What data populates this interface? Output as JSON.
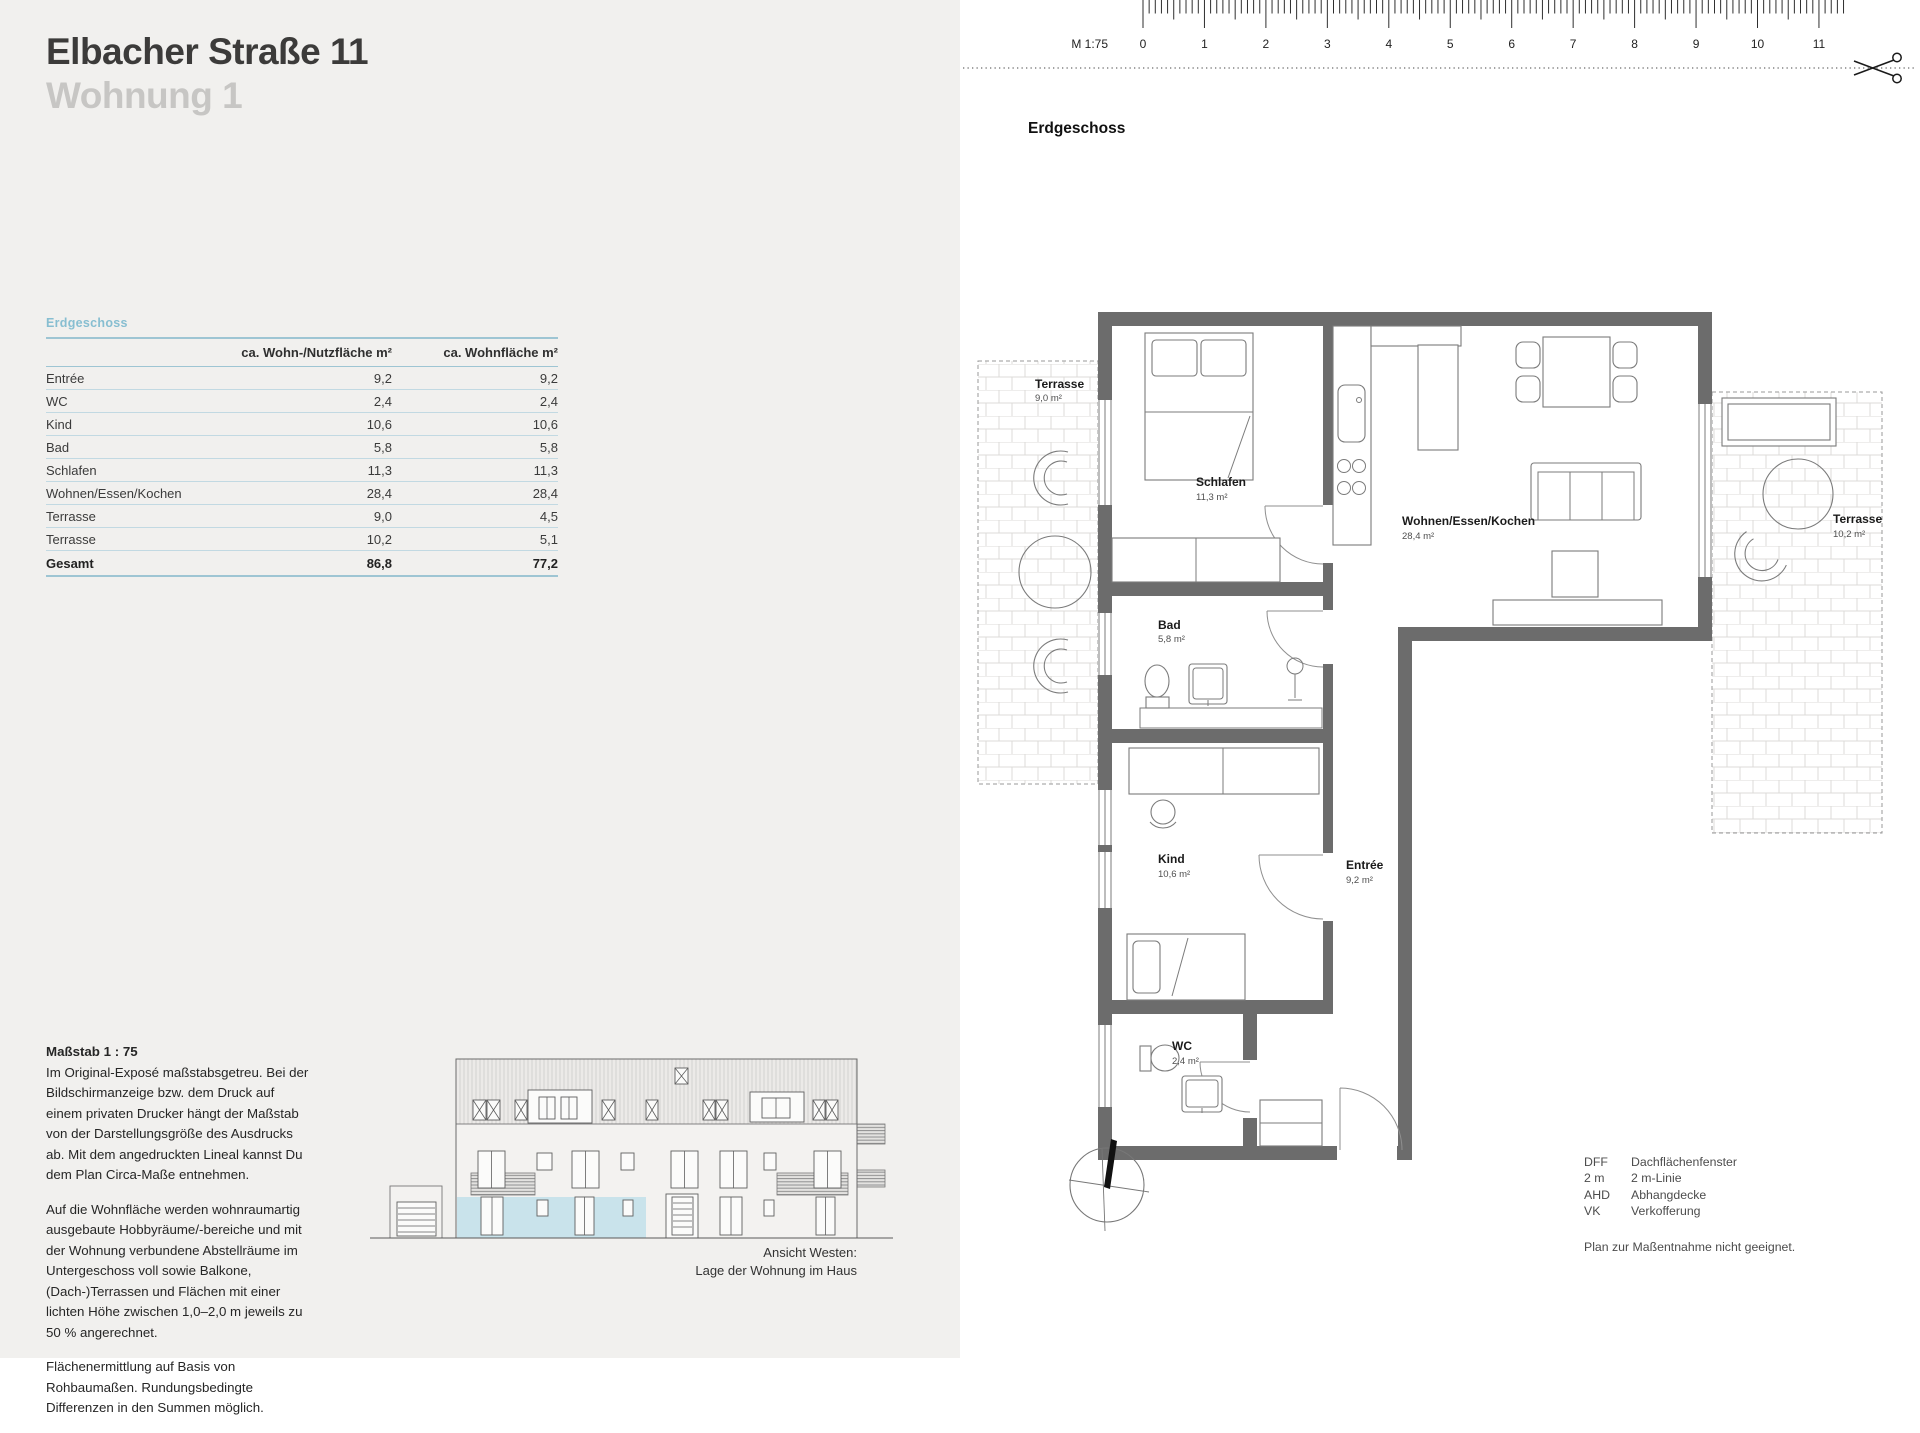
{
  "header": {
    "title": "Elbacher Straße 11",
    "subtitle": "Wohnung 1"
  },
  "area_table": {
    "section_label": "Erdgeschoss",
    "columns": [
      "ca. Wohn-/Nutzfläche m²",
      "ca. Wohnfläche m²"
    ],
    "rows": [
      {
        "name": "Entrée",
        "nutz": "9,2",
        "wohn": "9,2"
      },
      {
        "name": "WC",
        "nutz": "2,4",
        "wohn": "2,4"
      },
      {
        "name": "Kind",
        "nutz": "10,6",
        "wohn": "10,6"
      },
      {
        "name": "Bad",
        "nutz": "5,8",
        "wohn": "5,8"
      },
      {
        "name": "Schlafen",
        "nutz": "11,3",
        "wohn": "11,3"
      },
      {
        "name": "Wohnen/Essen/Kochen",
        "nutz": "28,4",
        "wohn": "28,4"
      },
      {
        "name": "Terrasse",
        "nutz": "9,0",
        "wohn": "4,5"
      },
      {
        "name": "Terrasse",
        "nutz": "10,2",
        "wohn": "5,1"
      }
    ],
    "total": {
      "name": "Gesamt",
      "nutz": "86,8",
      "wohn": "77,2"
    }
  },
  "notes": {
    "heading": "Maßstab 1 : 75",
    "p1": "Im Original-Exposé maßstabsgetreu. Bei der Bildschirmanzeige bzw. dem Druck auf einem privaten Drucker hängt der Maßstab von der Darstellungsgröße des Ausdrucks ab. Mit dem angedruckten Lineal kannst Du dem Plan Circa-Maße entnehmen.",
    "p2": "Auf die Wohnfläche werden wohnraumartig ausgebaute Hobbyräume/-bereiche und mit der Wohnung verbundene Abstellräume im Untergeschoss voll sowie Balkone, (Dach-)Terrassen und Flächen mit einer lichten Höhe zwischen 1,0–2,0 m jeweils zu 50 % angerechnet.",
    "p3": "Flächenermittlung auf Basis von Rohbaumaßen. Rundungsbedingte Differenzen in den Summen möglich."
  },
  "elevation": {
    "caption_line1": "Ansicht Westen:",
    "caption_line2": "Lage der Wohnung im Haus"
  },
  "ruler": {
    "scale_label": "M 1:75",
    "ticks": [
      "0",
      "1",
      "2",
      "3",
      "4",
      "5",
      "6",
      "7",
      "8",
      "9",
      "10",
      "11"
    ]
  },
  "plan": {
    "title": "Erdgeschoss",
    "rooms": [
      {
        "name": "Terrasse",
        "area": "9,0 m²"
      },
      {
        "name": "Schlafen",
        "area": "11,3 m²"
      },
      {
        "name": "Wohnen/Essen/Kochen",
        "area": "28,4 m²"
      },
      {
        "name": "Terrasse",
        "area": "10,2 m²"
      },
      {
        "name": "Bad",
        "area": "5,8 m²"
      },
      {
        "name": "Kind",
        "area": "10,6 m²"
      },
      {
        "name": "Entrée",
        "area": "9,2 m²"
      },
      {
        "name": "WC",
        "area": "2,4 m²"
      }
    ]
  },
  "legend": {
    "items": [
      {
        "abbr": "DFF",
        "label": "Dachflächenfenster"
      },
      {
        "abbr": "2 m",
        "label": "2 m-Linie"
      },
      {
        "abbr": "AHD",
        "label": "Abhangdecke"
      },
      {
        "abbr": "VK",
        "label": "Verkofferung"
      }
    ],
    "note": "Plan zur Maßentnahme nicht geeignet."
  },
  "colors": {
    "left_background": "#f1f0ee",
    "accent_blue": "#87bed1",
    "highlight_blue": "#c9e3eb",
    "wall_gray": "#6c6c6c"
  }
}
